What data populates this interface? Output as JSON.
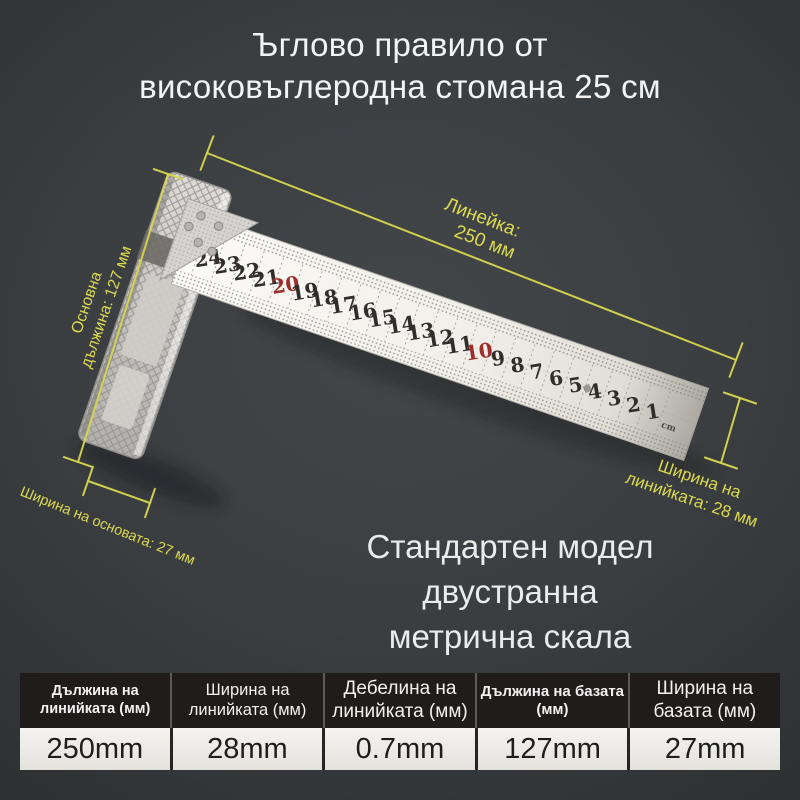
{
  "title": {
    "line1": "Ъглово правило от",
    "line2": "високовъглеродна стомана 25 см"
  },
  "subtitle": {
    "line1": "Стандартен модел",
    "line2": "двустранна",
    "line3": "метрична скала"
  },
  "annotations": {
    "ruler_length": {
      "line1": "Линейка:",
      "line2": "250 мм"
    },
    "base_length": {
      "line1": "Основна",
      "line2": "дължина: 127 мм"
    },
    "base_width": "Ширина на основата: 27 мм",
    "ruler_width": {
      "line1": "Ширина на",
      "line2": "линийката: 28 мм"
    }
  },
  "ruler": {
    "numbers": [
      "24",
      "23",
      "22",
      "21",
      "20",
      "19",
      "18",
      "17",
      "16",
      "15",
      "14",
      "13",
      "12",
      "11",
      "10",
      "9",
      "8",
      "7",
      "6",
      "5",
      "4",
      "3",
      "2",
      "1"
    ],
    "red_numbers": [
      "20",
      "10"
    ],
    "unit": "cm"
  },
  "table": {
    "columns": [
      {
        "header_l1": "Дължина на линийката (мм)",
        "header_l2": "",
        "value": "250mm"
      },
      {
        "header_l1": "Ширина на",
        "header_l2": "линийката (мм)",
        "value": "28mm"
      },
      {
        "header_l1": "Дебелина на",
        "header_l2": "линийката (мм)",
        "value": "0.7mm"
      },
      {
        "header_l1": "Дължина на базата (мм)",
        "header_l2": "",
        "value": "127mm"
      },
      {
        "header_l1": "Ширина на",
        "header_l2": "базата (мм)",
        "value": "27mm"
      }
    ]
  },
  "colors": {
    "background": "#3b3e41",
    "accent_yellow": "#d9d64f",
    "red_scale_number": "#9c2e2c",
    "table_header_bg": "#201c1c",
    "table_cell_bg": "#edebe7",
    "title_text": "#f3f3f3"
  }
}
